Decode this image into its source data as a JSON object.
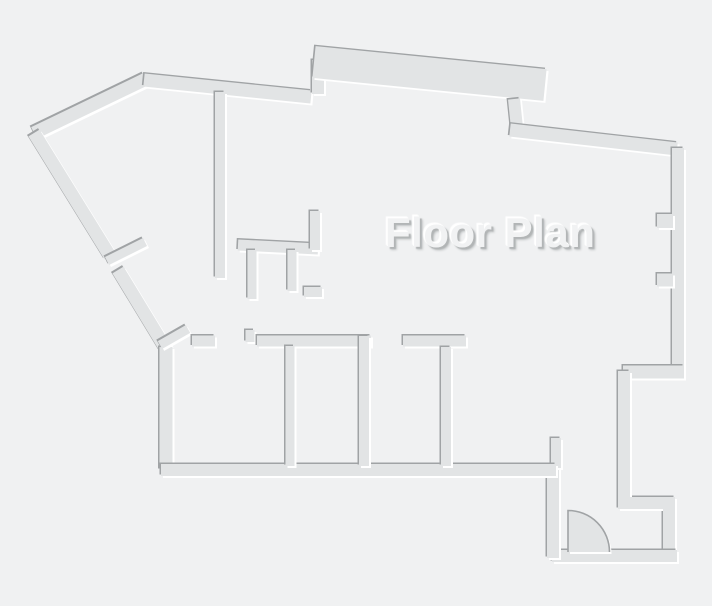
{
  "title": "Floor Plan",
  "canvas": {
    "width": 712,
    "height": 606
  },
  "colors": {
    "background": "#f0f1f2",
    "wall_fill": "#e2e4e5",
    "edge_shadow": "#a0a3a5",
    "edge_highlight": "#ffffff",
    "title_fill": "#f1f2f3",
    "title_shadow_dark": "#b2b5b6",
    "title_shadow_soft": "#c6c9ca",
    "title_highlight": "#ffffff"
  },
  "title_style": {
    "left": 385,
    "top": 211,
    "font_size": 42
  },
  "floorplan": {
    "emboss": {
      "shadow_dx": -1.5,
      "shadow_dy": -1.5,
      "highlight_dx": 2,
      "highlight_dy": 2
    },
    "walls": [
      {
        "n": "outer-diag-topleft",
        "d": "M 34 133 L 146 79",
        "w": 13
      },
      {
        "n": "outer-top",
        "d": "M 144 80 L 311 97",
        "w": 13
      },
      {
        "n": "notch-jog",
        "d": "M 318 60 L 318 94",
        "w": 12
      },
      {
        "n": "parapet-band",
        "d": "M 314 62 L 545 85",
        "w": 32
      },
      {
        "n": "band-stub",
        "d": "M 514 99 L 517 128",
        "w": 12
      },
      {
        "n": "outer-top-right",
        "d": "M 510 130 L 677 149",
        "w": 13
      },
      {
        "n": "outer-right",
        "d": "M 678 148 L 678 372",
        "w": 12
      },
      {
        "n": "right-tab-upper",
        "d": "M 673 221 L 657 221",
        "w": 14
      },
      {
        "n": "right-tab-lower",
        "d": "M 673 280 L 657 280",
        "w": 13
      },
      {
        "n": "recess-top",
        "d": "M 684 372 L 623 372",
        "w": 13
      },
      {
        "n": "recess-left-bottom",
        "d": "M 624 371 L 624 503 L 669 503 L 669 557",
        "w": 12
      },
      {
        "n": "entry-bottom",
        "d": "M 677 556 L 552 556",
        "w": 12
      },
      {
        "n": "entry-left",
        "d": "M 553 464 L 553 558",
        "w": 12
      },
      {
        "n": "doorway-stub",
        "d": "M 556 438 L 556 468",
        "w": 10
      },
      {
        "n": "outer-left-upper",
        "d": "M 34 133 L 110 256",
        "w": 13
      },
      {
        "n": "outer-left-lower",
        "d": "M 118 270 L 166 349",
        "w": 13
      },
      {
        "n": "outer-left-vert",
        "d": "M 166 347 L 166 470",
        "w": 13
      },
      {
        "n": "door-leaf-left",
        "d": "M 107 261 L 145 242",
        "w": 9
      },
      {
        "n": "door-leaf-corner",
        "d": "M 160 345 L 188 329",
        "w": 9
      },
      {
        "n": "interior-vert-main",
        "d": "M 220 92 L 220 278",
        "w": 10
      },
      {
        "n": "interior-horiz",
        "d": "M 238 245 L 318 249",
        "w": 11
      },
      {
        "n": "interior-stub-up",
        "d": "M 315 211 L 315 250",
        "w": 10
      },
      {
        "n": "interior-stub-down-a",
        "d": "M 252 250 L 252 299",
        "w": 9
      },
      {
        "n": "interior-stub-down-b",
        "d": "M 292 250 L 292 291",
        "w": 9
      },
      {
        "n": "interior-ledge",
        "d": "M 304 292 L 322 292",
        "w": 10
      },
      {
        "n": "roomtop-left",
        "d": "M 192 341 L 215 341",
        "w": 11
      },
      {
        "n": "roomtop-jamb",
        "d": "M 250 330 L 250 342",
        "w": 9
      },
      {
        "n": "roomtop-mid",
        "d": "M 257 341 L 371 341",
        "w": 11
      },
      {
        "n": "roomtop-right",
        "d": "M 403 341 L 466 341",
        "w": 11
      },
      {
        "n": "rooms-bottom",
        "d": "M 161 470 L 556 470",
        "w": 12
      },
      {
        "n": "room-divider-1",
        "d": "M 290 346 L 290 466",
        "w": 9
      },
      {
        "n": "room-divider-2",
        "d": "M 364 336 L 364 466",
        "w": 10
      },
      {
        "n": "room-divider-3",
        "d": "M 446 347 L 446 466",
        "w": 10
      }
    ],
    "door_arc": {
      "cx": 568,
      "cy": 552,
      "r": 41.5,
      "leaf_top_y": 510.5,
      "arc_end_x": 609.5
    }
  }
}
